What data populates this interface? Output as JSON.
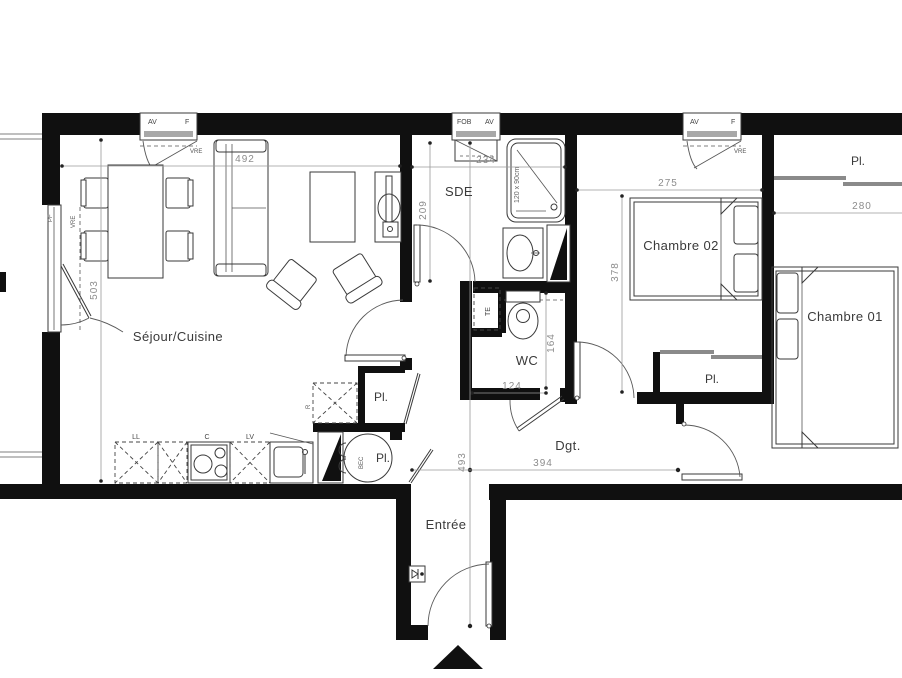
{
  "plan": {
    "rooms": {
      "sejour": "Séjour/Cuisine",
      "sde": "SDE",
      "wc": "WC",
      "chambre02": "Chambre 02",
      "chambre01": "Chambre 01",
      "dgt": "Dgt.",
      "entree": "Entrée"
    },
    "closet_label": "Pl.",
    "equipment": {
      "washer": "LL",
      "cooktop": "C",
      "dishwasher": "LV",
      "fridge": "R",
      "water_heater": "BEC",
      "shaft": "TE",
      "french_window": "PF",
      "shower_size": "120 x 90cm"
    },
    "windows": {
      "av": "AV",
      "f": "F",
      "fob": "FOB",
      "vre": "VRE"
    },
    "dimensions": {
      "sejour_w": "492",
      "sejour_h": "503",
      "sde_w": "234",
      "sde_h": "209",
      "ch2_w": "275",
      "ch2_h": "378",
      "ch1_w": "280",
      "wc_h": "164",
      "wc_w": "124",
      "hall_h": "493",
      "hall_w": "394"
    }
  }
}
